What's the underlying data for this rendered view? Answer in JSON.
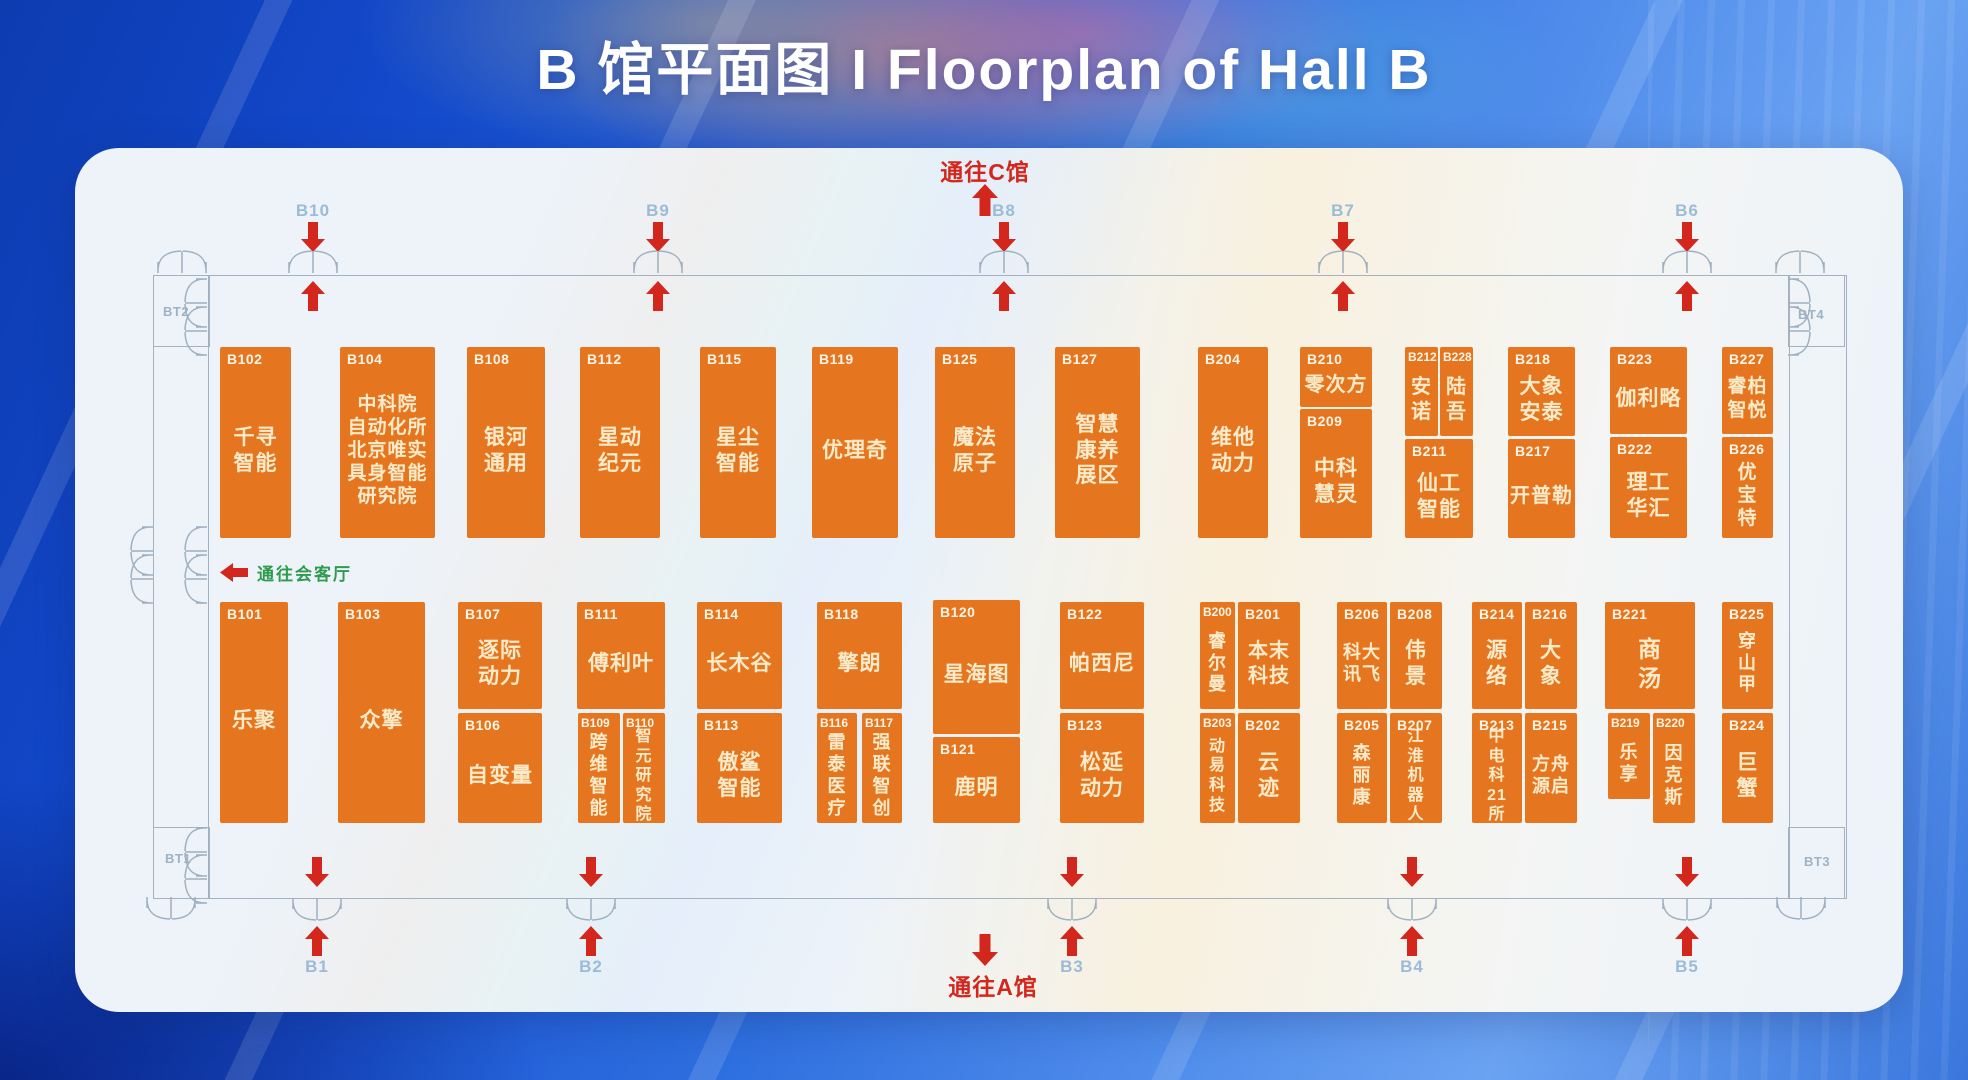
{
  "title": "B 馆平面图 I Floorplan of Hall B",
  "signs": {
    "to_c": "通往C馆",
    "to_a": "通往A馆",
    "to_lounge": "通往会客厅"
  },
  "colors": {
    "booth_orange": "#e6751f",
    "booth_text": "#f9ebc9",
    "arrow_red": "#d3261d",
    "gate_label_blue": "#9cbbd8",
    "lounge_green": "#2e9b4f",
    "wall_gray": "#a3b2c3"
  },
  "gates": {
    "top": [
      {
        "id": "B10",
        "x": 313
      },
      {
        "id": "B9",
        "x": 658
      },
      {
        "id": "B8",
        "x": 1004
      },
      {
        "id": "B7",
        "x": 1343
      },
      {
        "id": "B6",
        "x": 1687
      }
    ],
    "bottom": [
      {
        "id": "B1",
        "x": 317
      },
      {
        "id": "B2",
        "x": 591
      },
      {
        "id": "B3",
        "x": 1072
      },
      {
        "id": "B4",
        "x": 1412
      },
      {
        "id": "B5",
        "x": 1687
      }
    ]
  },
  "corner_labels": [
    {
      "id": "BT2",
      "x": 163,
      "y": 304
    },
    {
      "id": "BT4",
      "x": 1798,
      "y": 307
    },
    {
      "id": "BT1",
      "x": 165,
      "y": 851
    },
    {
      "id": "BT3",
      "x": 1804,
      "y": 854
    }
  ],
  "doors": [
    {
      "cx": 182,
      "cy": 260,
      "o": "up"
    },
    {
      "cx": 1800,
      "cy": 260,
      "o": "up"
    },
    {
      "cx": 194,
      "cy": 303,
      "o": "left"
    },
    {
      "cx": 194,
      "cy": 331,
      "o": "left"
    },
    {
      "cx": 1801,
      "cy": 303,
      "o": "right"
    },
    {
      "cx": 1801,
      "cy": 331,
      "o": "right"
    },
    {
      "cx": 194,
      "cy": 551,
      "o": "left"
    },
    {
      "cx": 194,
      "cy": 579,
      "o": "left"
    },
    {
      "cx": 140,
      "cy": 551,
      "o": "left"
    },
    {
      "cx": 140,
      "cy": 579,
      "o": "left"
    },
    {
      "cx": 194,
      "cy": 852,
      "o": "left"
    },
    {
      "cx": 194,
      "cy": 879,
      "o": "left"
    },
    {
      "cx": 171,
      "cy": 910,
      "o": "down"
    },
    {
      "cx": 1801,
      "cy": 910,
      "o": "down"
    }
  ],
  "booths": [
    {
      "id": "B102",
      "x": 220,
      "y": 347,
      "w": 71,
      "h": 191,
      "lines": [
        "千寻",
        "智能"
      ]
    },
    {
      "id": "B104",
      "x": 340,
      "y": 347,
      "w": 95,
      "h": 191,
      "lines": [
        "中科院",
        "自动化所",
        "北京唯实",
        "具身智能",
        "研究院"
      ],
      "fs": 19
    },
    {
      "id": "B108",
      "x": 467,
      "y": 347,
      "w": 78,
      "h": 191,
      "lines": [
        "银河",
        "通用"
      ]
    },
    {
      "id": "B112",
      "x": 580,
      "y": 347,
      "w": 80,
      "h": 191,
      "lines": [
        "星动",
        "纪元"
      ]
    },
    {
      "id": "B115",
      "x": 700,
      "y": 347,
      "w": 76,
      "h": 191,
      "lines": [
        "星尘",
        "智能"
      ]
    },
    {
      "id": "B119",
      "x": 812,
      "y": 347,
      "w": 86,
      "h": 191,
      "lines": [
        "优理奇"
      ]
    },
    {
      "id": "B125",
      "x": 935,
      "y": 347,
      "w": 80,
      "h": 191,
      "lines": [
        "魔法",
        "原子"
      ]
    },
    {
      "id": "B127",
      "x": 1055,
      "y": 347,
      "w": 85,
      "h": 191,
      "lines": [
        "智慧",
        "康养",
        "展区"
      ]
    },
    {
      "id": "B204",
      "x": 1198,
      "y": 347,
      "w": 70,
      "h": 191,
      "lines": [
        "维他",
        "动力"
      ]
    },
    {
      "id": "B210",
      "x": 1300,
      "y": 347,
      "w": 72,
      "h": 60,
      "lines": [
        "零次方"
      ],
      "fs": 20
    },
    {
      "id": "B209",
      "x": 1300,
      "y": 409,
      "w": 72,
      "h": 129,
      "lines": [
        "中科",
        "慧灵"
      ]
    },
    {
      "id": "B212",
      "x": 1405,
      "y": 347,
      "w": 33,
      "h": 89,
      "lines": [
        "安",
        "诺"
      ],
      "v": 1,
      "fs": 20
    },
    {
      "id": "B228",
      "x": 1440,
      "y": 347,
      "w": 33,
      "h": 89,
      "lines": [
        "陆",
        "吾"
      ],
      "v": 1,
      "fs": 20
    },
    {
      "id": "B211",
      "x": 1405,
      "y": 439,
      "w": 68,
      "h": 99,
      "lines": [
        "仙工",
        "智能"
      ]
    },
    {
      "id": "B218",
      "x": 1508,
      "y": 347,
      "w": 67,
      "h": 89,
      "lines": [
        "大象",
        "安泰"
      ]
    },
    {
      "id": "B217",
      "x": 1508,
      "y": 439,
      "w": 67,
      "h": 99,
      "lines": [
        "开普勒"
      ],
      "fs": 20
    },
    {
      "id": "B223",
      "x": 1610,
      "y": 347,
      "w": 77,
      "h": 87,
      "lines": [
        "伽利略"
      ]
    },
    {
      "id": "B222",
      "x": 1610,
      "y": 437,
      "w": 77,
      "h": 101,
      "lines": [
        "理工",
        "华汇"
      ]
    },
    {
      "id": "B227",
      "x": 1722,
      "y": 347,
      "w": 51,
      "h": 87,
      "lines": [
        "睿柏",
        "智悦"
      ],
      "fs": 19
    },
    {
      "id": "B226",
      "x": 1722,
      "y": 437,
      "w": 51,
      "h": 101,
      "lines": [
        "优",
        "宝",
        "特"
      ],
      "v": 1,
      "fs": 19
    },
    {
      "id": "B101",
      "x": 220,
      "y": 602,
      "w": 68,
      "h": 221,
      "lines": [
        "乐聚"
      ]
    },
    {
      "id": "B103",
      "x": 338,
      "y": 602,
      "w": 87,
      "h": 221,
      "lines": [
        "众擎"
      ]
    },
    {
      "id": "B107",
      "x": 458,
      "y": 602,
      "w": 84,
      "h": 107,
      "lines": [
        "逐际",
        "动力"
      ]
    },
    {
      "id": "B106",
      "x": 458,
      "y": 713,
      "w": 84,
      "h": 110,
      "lines": [
        "自变量"
      ]
    },
    {
      "id": "B111",
      "x": 577,
      "y": 602,
      "w": 88,
      "h": 107,
      "lines": [
        "傅利叶"
      ]
    },
    {
      "id": "B109",
      "x": 578,
      "y": 713,
      "w": 42,
      "h": 110,
      "lines": [
        "跨",
        "维",
        "智",
        "能"
      ],
      "v": 1,
      "fs": 18
    },
    {
      "id": "B110",
      "x": 623,
      "y": 713,
      "w": 42,
      "h": 110,
      "lines": [
        "智",
        "元",
        "研",
        "究",
        "院"
      ],
      "v": 1,
      "fs": 16
    },
    {
      "id": "B114",
      "x": 697,
      "y": 602,
      "w": 85,
      "h": 107,
      "lines": [
        "长木谷"
      ]
    },
    {
      "id": "B113",
      "x": 697,
      "y": 713,
      "w": 85,
      "h": 110,
      "lines": [
        "傲鲨",
        "智能"
      ]
    },
    {
      "id": "B118",
      "x": 817,
      "y": 602,
      "w": 85,
      "h": 107,
      "lines": [
        "擎朗"
      ]
    },
    {
      "id": "B116",
      "x": 817,
      "y": 713,
      "w": 40,
      "h": 110,
      "lines": [
        "雷",
        "泰",
        "医",
        "疗"
      ],
      "v": 1,
      "fs": 18
    },
    {
      "id": "B117",
      "x": 862,
      "y": 713,
      "w": 40,
      "h": 110,
      "lines": [
        "强",
        "联",
        "智",
        "创"
      ],
      "v": 1,
      "fs": 18
    },
    {
      "id": "B120",
      "x": 933,
      "y": 600,
      "w": 87,
      "h": 134,
      "lines": [
        "星海图"
      ]
    },
    {
      "id": "B121",
      "x": 933,
      "y": 737,
      "w": 87,
      "h": 86,
      "lines": [
        "鹿明"
      ]
    },
    {
      "id": "B122",
      "x": 1060,
      "y": 602,
      "w": 84,
      "h": 107,
      "lines": [
        "帕西尼"
      ]
    },
    {
      "id": "B123",
      "x": 1060,
      "y": 713,
      "w": 84,
      "h": 110,
      "lines": [
        "松延",
        "动力"
      ]
    },
    {
      "id": "B200",
      "x": 1200,
      "y": 602,
      "w": 35,
      "h": 107,
      "lines": [
        "睿",
        "尔",
        "曼"
      ],
      "v": 1,
      "fs": 18
    },
    {
      "id": "B201",
      "x": 1238,
      "y": 602,
      "w": 62,
      "h": 107,
      "lines": [
        "本末",
        "科技"
      ],
      "fs": 20
    },
    {
      "id": "B203",
      "x": 1200,
      "y": 713,
      "w": 35,
      "h": 110,
      "lines": [
        "动",
        "易",
        "科",
        "技"
      ],
      "v": 1,
      "fs": 16
    },
    {
      "id": "B202",
      "x": 1238,
      "y": 713,
      "w": 62,
      "h": 110,
      "lines": [
        "云",
        "迹"
      ],
      "v": 1
    },
    {
      "id": "B206",
      "x": 1337,
      "y": 602,
      "w": 50,
      "h": 107,
      "lines": [
        "科大",
        "讯飞"
      ],
      "fs": 18
    },
    {
      "id": "B208",
      "x": 1390,
      "y": 602,
      "w": 52,
      "h": 107,
      "lines": [
        "伟",
        "景"
      ],
      "v": 1
    },
    {
      "id": "B205",
      "x": 1337,
      "y": 713,
      "w": 50,
      "h": 110,
      "lines": [
        "森",
        "丽",
        "康"
      ],
      "v": 1,
      "fs": 18
    },
    {
      "id": "B207",
      "x": 1390,
      "y": 713,
      "w": 52,
      "h": 110,
      "lines": [
        "江",
        "淮",
        "机",
        "器",
        "人"
      ],
      "v": 1,
      "fs": 16
    },
    {
      "id": "B214",
      "x": 1472,
      "y": 602,
      "w": 50,
      "h": 107,
      "lines": [
        "源",
        "络"
      ],
      "v": 1
    },
    {
      "id": "B216",
      "x": 1525,
      "y": 602,
      "w": 52,
      "h": 107,
      "lines": [
        "大",
        "象"
      ],
      "v": 1
    },
    {
      "id": "B213",
      "x": 1472,
      "y": 713,
      "w": 50,
      "h": 110,
      "lines": [
        "中",
        "电",
        "科",
        "21",
        "所"
      ],
      "v": 1,
      "fs": 16
    },
    {
      "id": "B215",
      "x": 1525,
      "y": 713,
      "w": 52,
      "h": 110,
      "lines": [
        "方舟",
        "源启"
      ],
      "fs": 18
    },
    {
      "id": "B221",
      "x": 1605,
      "y": 602,
      "w": 90,
      "h": 107,
      "lines": [
        "商",
        "汤"
      ],
      "v": 1,
      "fs": 23
    },
    {
      "id": "B219",
      "x": 1608,
      "y": 713,
      "w": 42,
      "h": 86,
      "lines": [
        "乐",
        "享"
      ],
      "v": 1,
      "fs": 18
    },
    {
      "id": "B220",
      "x": 1653,
      "y": 713,
      "w": 42,
      "h": 110,
      "lines": [
        "因",
        "克",
        "斯"
      ],
      "v": 1,
      "fs": 18
    },
    {
      "id": "B225",
      "x": 1722,
      "y": 602,
      "w": 51,
      "h": 107,
      "lines": [
        "穿",
        "山",
        "甲"
      ],
      "v": 1,
      "fs": 18
    },
    {
      "id": "B224",
      "x": 1722,
      "y": 713,
      "w": 51,
      "h": 110,
      "lines": [
        "巨",
        "蟹"
      ],
      "v": 1
    }
  ]
}
